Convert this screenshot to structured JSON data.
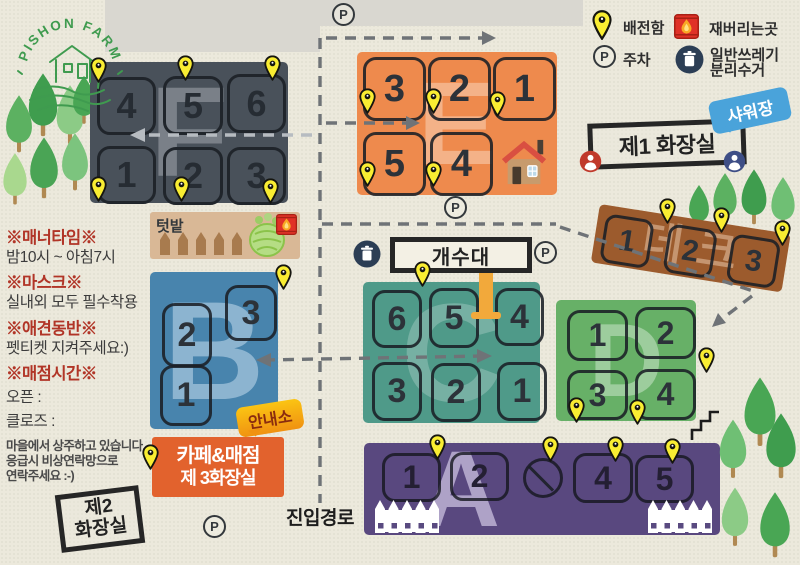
{
  "colors": {
    "pin_yellow": "#f9ed32",
    "zone_f_gray": "#49515a",
    "zone_e_orange": "#ee8a4d",
    "zone_b_blue": "#4884ad",
    "zone_c_teal": "#4f9a89",
    "zone_d_green": "#67b067",
    "zone_a_purple": "#59487f",
    "deck_brown": "#9c5b2d",
    "cafe_orange": "#e2622d",
    "shower_blue": "#4aa3da",
    "info_yellow": "#f6b211"
  },
  "logo": {
    "name": "PISHON FARM"
  },
  "legend": {
    "pin_label": "배전함",
    "parking_label": "주차",
    "fire_label": "재버리는곳",
    "trash_label_line1": "일반쓰레기",
    "trash_label_line2": "분리수거"
  },
  "notices": {
    "n1_title": "※매너타임※",
    "n1_body": "밤10시 ~ 아침7시",
    "n2_title": "※마스크※",
    "n2_body": "실내외 모두 필수착용",
    "n3_title": "※애견동반※",
    "n3_body": "펫티켓 지켜주세요:)",
    "n4_title": "※매점시간※",
    "n4_open": "오픈 :",
    "n4_close": "클로즈 :",
    "footer_line1": "마을에서 상주하고 있습니다.",
    "footer_line2": "응급시 비상연락망으로",
    "footer_line3": "연락주세요 :-)"
  },
  "zones": {
    "F": {
      "letter": "F",
      "r1c1": "4",
      "r1c2": "5",
      "r1c3": "6",
      "r2c1": "1",
      "r2c2": "2",
      "r2c3": "3"
    },
    "E": {
      "letter": "E",
      "r1c1": "3",
      "r1c2": "2",
      "r1c3": "1",
      "r2c1": "5",
      "r2c2": "4"
    },
    "B": {
      "letter": "B",
      "s3": "3",
      "s2": "2",
      "s1": "1"
    },
    "C": {
      "letter": "C",
      "r1c1": "6",
      "r1c2": "5",
      "r1c3": "4",
      "r2c1": "3",
      "r2c2": "2",
      "r2c3": "1"
    },
    "D": {
      "letter": "D",
      "r1c1": "1",
      "r1c2": "2",
      "r2c1": "3",
      "r2c2": "4"
    },
    "A": {
      "letter": "A",
      "s1": "1",
      "s2": "2",
      "s4": "4",
      "s5": "5"
    },
    "deck": {
      "letter": "데크",
      "s1": "1",
      "s2": "2",
      "s3": "3"
    }
  },
  "labels": {
    "garden": "텃밭",
    "shower": "샤워장",
    "restroom1": "제1 화장실",
    "restroom2_line1": "제2",
    "restroom2_line2": "화장실",
    "sink": "개수대",
    "info": "안내소",
    "cafe_line1": "카페&매점",
    "cafe_line2": "제 3화장실",
    "entry": "진입경로",
    "parking": "P"
  }
}
